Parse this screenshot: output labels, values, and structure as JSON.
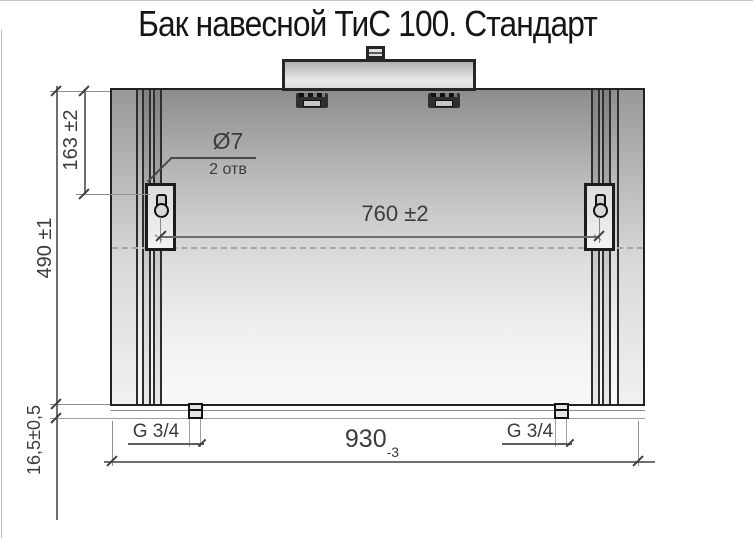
{
  "title": "Бак навесной ТиС 100. Стандарт",
  "labels": {
    "dim_163": "163 ±2",
    "dim_490": "490 ±1",
    "dim_16_5": "16,5±0,5",
    "dim_760": "760 ±2",
    "dim_930": "930",
    "dim_930_tol": "-3",
    "hole_dia": "Ø7",
    "hole_count": "2 отв",
    "g_left": "G 3/4",
    "g_right": "G 3/4"
  },
  "colors": {
    "outline": "#222222",
    "dimension_line": "#6e6e6e",
    "text": "#3c3c3c"
  }
}
